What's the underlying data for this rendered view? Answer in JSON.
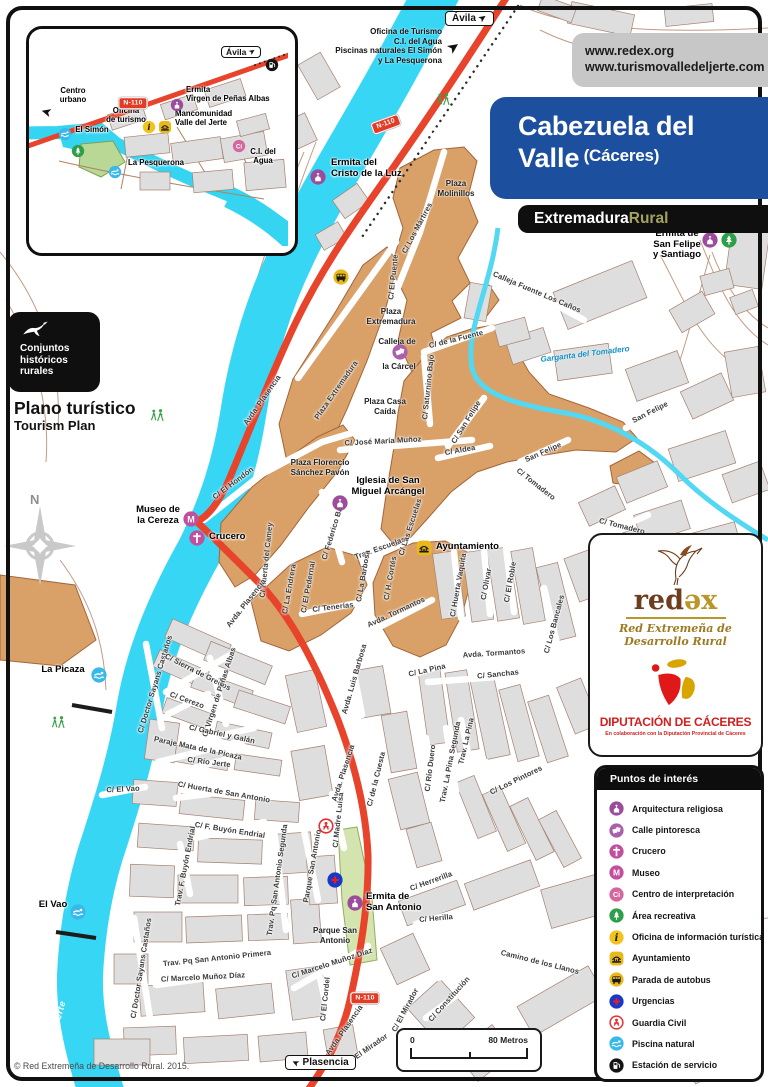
{
  "header": {
    "urls": [
      "www.redex.org",
      "www.turismovalledeljerte.com"
    ],
    "title_line1": "Cabezuela del",
    "title_line2": "Valle",
    "subtitle": "(Cáceres)",
    "brand_white": "Extremadura",
    "brand_olive": "Rural",
    "colors": {
      "title_bg": "#1d4f9f",
      "url_bg": "#c7c7c7",
      "brand_bg": "#0f0f0f",
      "olive": "#a3a35f"
    }
  },
  "badges": {
    "conjuntos_lines": [
      "Conjuntos",
      "históricos",
      "rurales"
    ],
    "plan_title": "Plano turístico",
    "plan_subtitle": "Tourism Plan",
    "north": "N"
  },
  "directions": {
    "lines": [
      "Oficina de Turismo",
      "C.I. del Agua",
      "Piscinas naturales El Simón",
      "y La Pesquerona"
    ]
  },
  "map": {
    "n110_label": "N-110",
    "avila_label": "Ávila",
    "colors": {
      "river": "#38d6f5",
      "road": "#e8432b",
      "historic": "#d9a168",
      "blocks": "#dedede",
      "park": "#d4e4ae"
    },
    "streets": [
      [
        "Avda. Plasencia",
        262,
        400,
        -55
      ],
      [
        "Plaza Extremadura",
        336,
        390,
        -55
      ],
      [
        "C/ El Puente",
        393,
        277,
        -84
      ],
      [
        "C/ Los Mártires",
        417,
        228,
        -62
      ],
      [
        "C/ El Hondón",
        233,
        483,
        -37
      ],
      [
        "Calleja Fuente Los Caños",
        537,
        292,
        23
      ],
      [
        "C/ de la Fuente",
        456,
        339,
        -14
      ],
      [
        "C/ Saturnino Bajo",
        428,
        387,
        -84
      ],
      [
        "C/ San Felipe",
        466,
        422,
        -58
      ],
      [
        "C/ Aldea",
        460,
        450,
        -10
      ],
      [
        "San Felipe",
        650,
        412,
        -27
      ],
      [
        "San Felipe",
        543,
        452,
        -24
      ],
      [
        "C/ Tomadero",
        536,
        484,
        38
      ],
      [
        "C/ Tomadero",
        622,
        526,
        14
      ],
      [
        "C/ José María Muñoz",
        383,
        441,
        -3
      ],
      [
        "C/ Federico Bajo",
        333,
        530,
        -73
      ],
      [
        "Trav. Escuelas",
        380,
        548,
        -20
      ],
      [
        "C/ Las Escuelas",
        410,
        527,
        -72
      ],
      [
        "C/ La Barbosa",
        363,
        576,
        -80
      ],
      [
        "C/ H. Cortés",
        390,
        578,
        -80
      ],
      [
        "C/ Huerta Vaquita",
        458,
        585,
        -80
      ],
      [
        "C/ Olivar",
        486,
        584,
        -80
      ],
      [
        "C/ El Roble",
        510,
        582,
        -80
      ],
      [
        "C/ Los Bancales",
        554,
        624,
        -75
      ],
      [
        "Avda. Tormantos",
        396,
        612,
        -25
      ],
      [
        "Avda. Tormantos",
        494,
        653,
        -4
      ],
      [
        "C/ Sanchas",
        498,
        674,
        -6
      ],
      [
        "C/ La Pina",
        427,
        670,
        -13
      ],
      [
        "Trav. La Pina",
        466,
        741,
        -77
      ],
      [
        "Trav. La Pina Segunda",
        450,
        762,
        -79
      ],
      [
        "C/ Río Duero",
        430,
        768,
        -83
      ],
      [
        "C/ Los Pintores",
        516,
        780,
        -26
      ],
      [
        "C/ de la Cuesta",
        376,
        779,
        -76
      ],
      [
        "Avda. Luis Barbosa",
        354,
        679,
        -74
      ],
      [
        "C/ Tenerías",
        333,
        607,
        -7
      ],
      [
        "C/ Huerta del Camey",
        266,
        560,
        -84
      ],
      [
        "C/ La Endrera",
        289,
        589,
        -80
      ],
      [
        "C/ El Pedernal",
        308,
        587,
        -80
      ],
      [
        "Avda. Plasencia",
        246,
        603,
        -52
      ],
      [
        "Avda. Plasencia",
        343,
        773,
        -72
      ],
      [
        "Avda. Plasencia",
        344,
        1030,
        -55
      ],
      [
        "C/ Doctor Sayans Castaños",
        155,
        684,
        -73
      ],
      [
        "C/ Doctor Sayans Castaños",
        141,
        968,
        -81
      ],
      [
        "C/ Sierra de Gredos",
        198,
        672,
        27
      ],
      [
        "C/ Cerezo",
        187,
        700,
        20
      ],
      [
        "C/ Virgen de Peñas Albas",
        219,
        692,
        -72
      ],
      [
        "C/ Gabriel y Galán",
        222,
        734,
        12
      ],
      [
        "Paraje Mata de la Picaza",
        198,
        748,
        12
      ],
      [
        "C/ Río Jerte",
        209,
        762,
        7
      ],
      [
        "C/ El Vao",
        123,
        789,
        -3
      ],
      [
        "C/ Huerta de San Antonio",
        224,
        792,
        10
      ],
      [
        "C/ F. Buyón Endrial",
        230,
        830,
        9
      ],
      [
        "Trav. F. Buyón Endrial",
        185,
        866,
        -79
      ],
      [
        "C/ Madre Luisa",
        338,
        820,
        -84
      ],
      [
        "Trav. Pq San Antonio Segunda",
        277,
        880,
        -82
      ],
      [
        "Parque San Antonio",
        312,
        866,
        -80
      ],
      [
        "C/ Herrerilla",
        431,
        881,
        -20
      ],
      [
        "C/ Herilla",
        436,
        918,
        -5
      ],
      [
        "Camino de los Llanos",
        540,
        962,
        14
      ],
      [
        "C/ Marcelo Muñoz Díaz",
        332,
        963,
        -18
      ],
      [
        "C/ Marcelo Muñoz Díaz",
        203,
        977,
        -3
      ],
      [
        "Trav. Pq San Antonio Primera",
        217,
        958,
        -6
      ],
      [
        "C/ El Cordel",
        325,
        999,
        -84
      ],
      [
        "C/ El Mirador",
        405,
        1010,
        -62
      ],
      [
        "C/ El Mirador",
        367,
        1049,
        -35
      ],
      [
        "C/ Constitución",
        449,
        999,
        -48
      ]
    ],
    "water_labels": [
      [
        "Río Jerte",
        446,
        120,
        -55,
        "river"
      ],
      [
        "Río Jerte",
        184,
        428,
        -55,
        "river"
      ],
      [
        "Río Jerte",
        57,
        1022,
        -75,
        "river"
      ],
      [
        "Garganta del Tomadero",
        585,
        354,
        -7,
        "stream"
      ]
    ],
    "place_labels": [
      {
        "lines": [
          "Plaza",
          "Molinillos"
        ],
        "x": 456,
        "y": 179
      },
      {
        "lines": [
          "Plaza",
          "Extremadura"
        ],
        "x": 391,
        "y": 307
      },
      {
        "lines": [
          "Calleja de"
        ],
        "x": 397,
        "y": 337
      },
      {
        "lines": [
          "la Cárcel"
        ],
        "x": 399,
        "y": 362
      },
      {
        "lines": [
          "Plaza Casa",
          "Caída"
        ],
        "x": 385,
        "y": 397
      },
      {
        "lines": [
          "Plaza Florencio",
          "Sánchez Pavón"
        ],
        "x": 320,
        "y": 458
      },
      {
        "lines": [
          "Parque San",
          "Antonio"
        ],
        "x": 335,
        "y": 926
      }
    ],
    "poi_labels": [
      {
        "lines": [
          "Ermita del",
          "Cristo de la Luz"
        ],
        "x": 331,
        "y": 158,
        "align": "left"
      },
      {
        "lines": [
          "Ermita de",
          "San Felipe",
          "y Santiago"
        ],
        "x": 677,
        "y": 229,
        "align": "center"
      },
      {
        "lines": [
          "Museo de",
          "la Cereza"
        ],
        "x": 158,
        "y": 505,
        "align": "center"
      },
      {
        "lines": [
          "Crucero"
        ],
        "x": 209,
        "y": 532,
        "align": "left"
      },
      {
        "lines": [
          "Iglesia de San",
          "Miguel Arcángel"
        ],
        "x": 388,
        "y": 476,
        "align": "center"
      },
      {
        "lines": [
          "Ayuntamiento"
        ],
        "x": 436,
        "y": 542,
        "align": "left"
      },
      {
        "lines": [
          "Ermita de",
          "San Antonio"
        ],
        "x": 366,
        "y": 892,
        "align": "left"
      },
      {
        "lines": [
          "La Picaza"
        ],
        "x": 63,
        "y": 665,
        "align": "center"
      },
      {
        "lines": [
          "El Vao"
        ],
        "x": 53,
        "y": 900,
        "align": "center"
      }
    ],
    "pois": [
      [
        "religiosa",
        318,
        177
      ],
      [
        "bus",
        341,
        277
      ],
      [
        "pintoresca",
        400,
        352
      ],
      [
        "religiosa",
        710,
        240
      ],
      [
        "area",
        729,
        240
      ],
      [
        "museo",
        191,
        519
      ],
      [
        "crucero",
        197,
        538
      ],
      [
        "religiosa",
        340,
        503
      ],
      [
        "ayto",
        424,
        548
      ],
      [
        "religiosa",
        355,
        903
      ],
      [
        "urgencias",
        335,
        880
      ],
      [
        "guardia",
        326,
        826
      ],
      [
        "piscina",
        99,
        675
      ],
      [
        "piscina",
        78,
        912
      ]
    ],
    "hikers": [
      [
        443,
        102
      ],
      [
        157,
        418
      ],
      [
        58,
        725
      ]
    ],
    "road_badges": [
      [
        386,
        124,
        -20
      ],
      [
        365,
        998,
        0
      ]
    ]
  },
  "inset": {
    "labels": [
      {
        "lines": [
          "Centro",
          "urbano"
        ],
        "x": 44,
        "y": 58,
        "align": "center"
      },
      {
        "lines": [
          "Ermita",
          "Virgen de Peñas Albas"
        ],
        "x": 157,
        "y": 57,
        "align": "left"
      },
      {
        "lines": [
          "Oficina",
          "de turismo"
        ],
        "x": 97,
        "y": 78,
        "align": "center"
      },
      {
        "lines": [
          "Mancomunidad",
          "Valle del Jerte"
        ],
        "x": 146,
        "y": 81,
        "align": "left"
      },
      {
        "lines": [
          "El Simón"
        ],
        "x": 63,
        "y": 97,
        "align": "center"
      },
      {
        "lines": [
          "La Pesquerona"
        ],
        "x": 127,
        "y": 130,
        "align": "center"
      },
      {
        "lines": [
          "C.I. del",
          "Agua"
        ],
        "x": 234,
        "y": 119,
        "align": "center"
      }
    ],
    "pois": [
      [
        "gas",
        243,
        36
      ],
      [
        "religiosa",
        148,
        76
      ],
      [
        "info",
        120,
        98
      ],
      [
        "ayto",
        136,
        98
      ],
      [
        "piscina",
        36,
        105
      ],
      [
        "area",
        49,
        122
      ],
      [
        "piscina",
        86,
        143
      ],
      [
        "ci",
        210,
        117
      ]
    ],
    "river_label": {
      "t": "Río Jerte",
      "x": 147,
      "y": 176,
      "r": -12
    },
    "badge": {
      "t": "N-110",
      "x": 104,
      "y": 74
    },
    "sign": {
      "t": "Ávila",
      "x": 214,
      "y": 25
    }
  },
  "logos": {
    "redex_p1": "red",
    "redex_p2": "əx",
    "redex_sub1": "Red Extremeña de",
    "redex_sub2": "Desarrollo  Rural",
    "dip_title": "DIPUTACIÓN DE CÁCERES",
    "dip_sub": "En colaboración con la Diputación Provincial de Cáceres"
  },
  "legend": {
    "title": "Puntos de interés",
    "items": [
      [
        "religiosa",
        "Arquitectura religiosa"
      ],
      [
        "pintoresca",
        "Calle pintoresca"
      ],
      [
        "crucero",
        "Crucero"
      ],
      [
        "museo",
        "Museo"
      ],
      [
        "ci",
        "Centro de interpretación"
      ],
      [
        "area",
        "Área recreativa"
      ],
      [
        "info",
        "Oficina de información turística"
      ],
      [
        "ayto",
        "Ayuntamiento"
      ],
      [
        "bus",
        "Parada de autobus"
      ],
      [
        "urgencias",
        "Urgencias"
      ],
      [
        "guardia",
        "Guardia Civil"
      ],
      [
        "piscina",
        "Piscina natural"
      ],
      [
        "gas",
        "Estación de servicio"
      ]
    ]
  },
  "footer": {
    "copyright": "© Red Extremeña de Desarrollo Rural. 2015.",
    "scale_start": "0",
    "scale_end": "80 Metros",
    "plasencia": "Plasencia"
  }
}
